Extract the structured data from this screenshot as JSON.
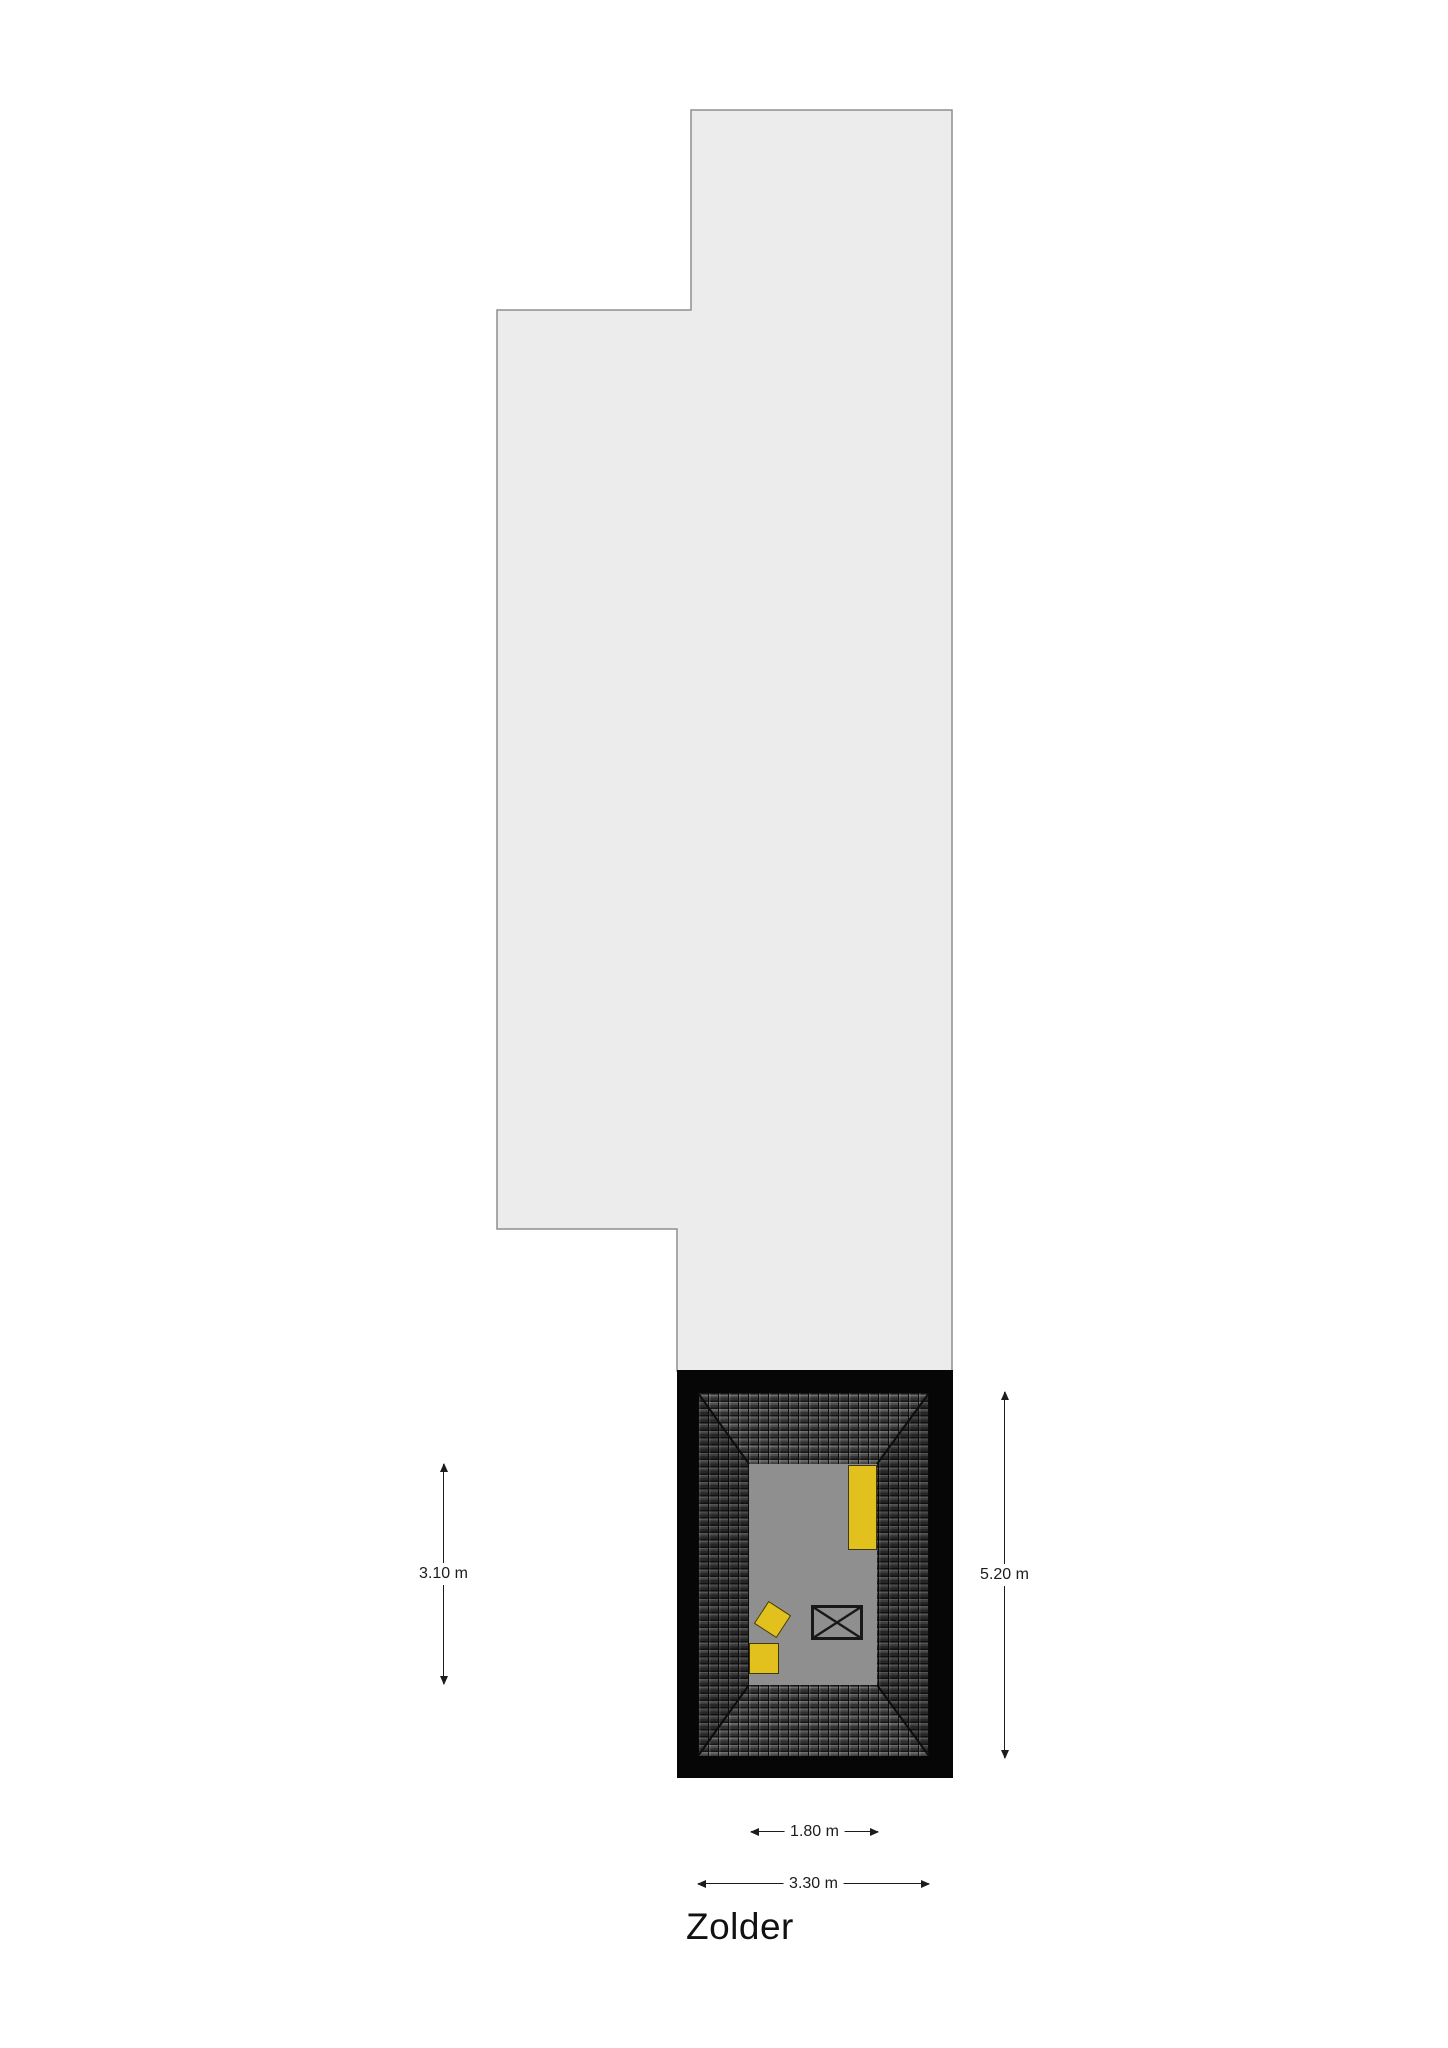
{
  "floorplan": {
    "room_label": "Zolder",
    "dimensions": {
      "inner_height": "3.10 m",
      "outer_height": "5.20 m",
      "inner_width": "1.80 m",
      "outer_width": "3.30 m"
    },
    "furniture": [
      {
        "type": "tall-cabinet",
        "color": "yellow"
      },
      {
        "type": "tilted-box",
        "color": "yellow"
      },
      {
        "type": "box",
        "color": "yellow"
      },
      {
        "type": "crossed-fixture",
        "color": "gray"
      }
    ],
    "colors": {
      "background": "#ffffff",
      "attic-fill": "#ececec",
      "attic-stroke": "#8e8e8e",
      "wall": "#060606",
      "tile-base": "#343434",
      "floor": "#8f8f8f",
      "furniture-yellow": "#e2c01e",
      "line": "#1c1c1c"
    }
  }
}
